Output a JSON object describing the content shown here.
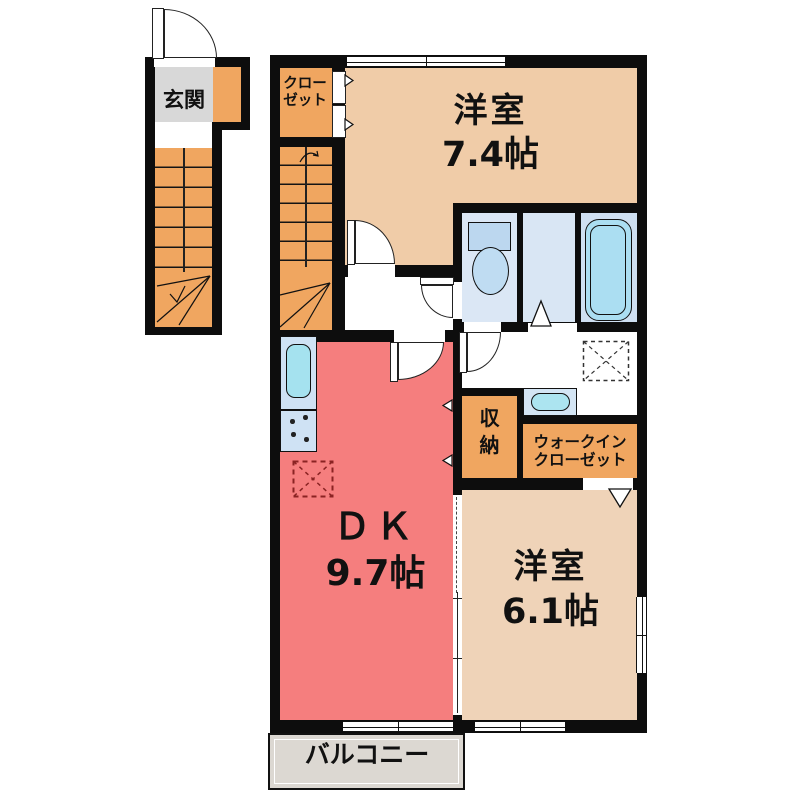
{
  "type": "apartment-floor-plan",
  "rooms": {
    "genkan": {
      "label": "玄関"
    },
    "closet": {
      "line1": "クロー",
      "line2": "ゼット"
    },
    "western_room_1": {
      "name": "洋室",
      "size": "7.4帖"
    },
    "dk": {
      "name": "ＤＫ",
      "size": "9.7帖"
    },
    "storage": {
      "char1": "収",
      "char2": "納"
    },
    "walk_in_closet": {
      "line1": "ウォークイン",
      "line2": "クローゼット"
    },
    "western_room_2": {
      "name": "洋室",
      "size": "6.1帖"
    },
    "balcony": {
      "label": "バルコニー"
    }
  },
  "colors": {
    "wall": "#0d0d0d",
    "western_room": "#f0cca8",
    "western_room_2": "#efd3b8",
    "dk": "#f57e7e",
    "stairs_closet_orange": "#f0a660",
    "genkan_gray": "#d8d8d8",
    "balcony_gray": "#dcd8d2",
    "toilet_room_blue": "#dbe7f5",
    "bath_blue": "#cfe0f2",
    "tub_cyan": "#abdef2",
    "sink_cyan": "#a5e2ef",
    "fixture_blue": "#bcd7ef",
    "fridge_marker_red": "#8a2323"
  },
  "icons": [
    "entry-door-arc",
    "interior-door-arc",
    "toilet-icon",
    "bathtub-icon",
    "kitchen-sink-icon",
    "stove-icon",
    "washbasin-icon",
    "refrigerator-space-marker",
    "laundry-space-marker",
    "exterior-stairs-icon",
    "interior-stairs-icon",
    "window",
    "sliding-partition",
    "closet-door-arrow",
    "folding-door-triangle"
  ]
}
